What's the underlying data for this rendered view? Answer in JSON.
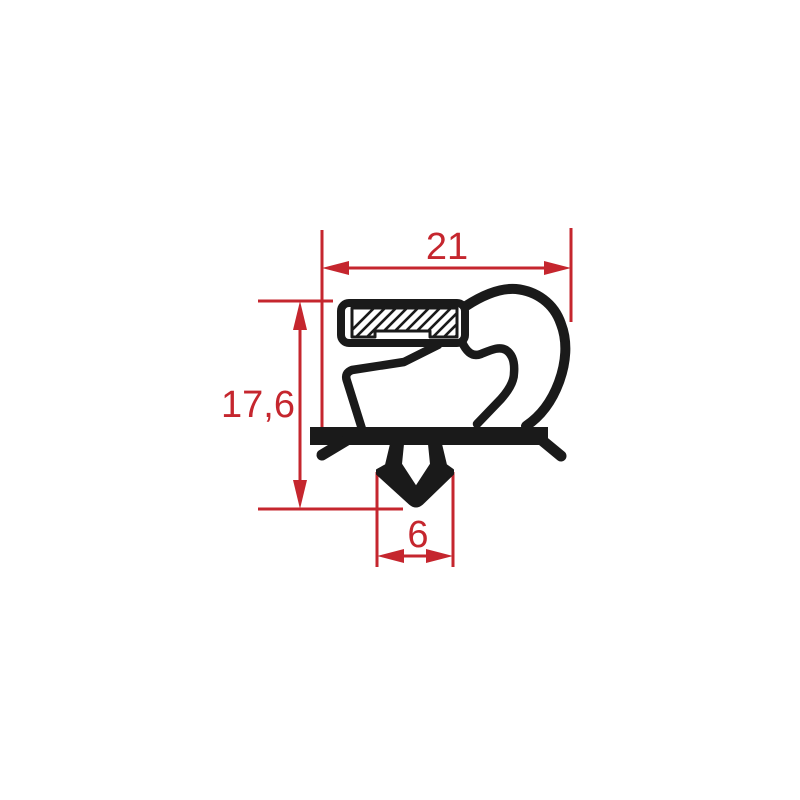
{
  "dimensions": {
    "width": "21",
    "height": "17,6",
    "foot": "6"
  },
  "colors": {
    "dimension_red": "#c5262e",
    "profile_black": "#1a1a1a",
    "background": "#ffffff"
  }
}
